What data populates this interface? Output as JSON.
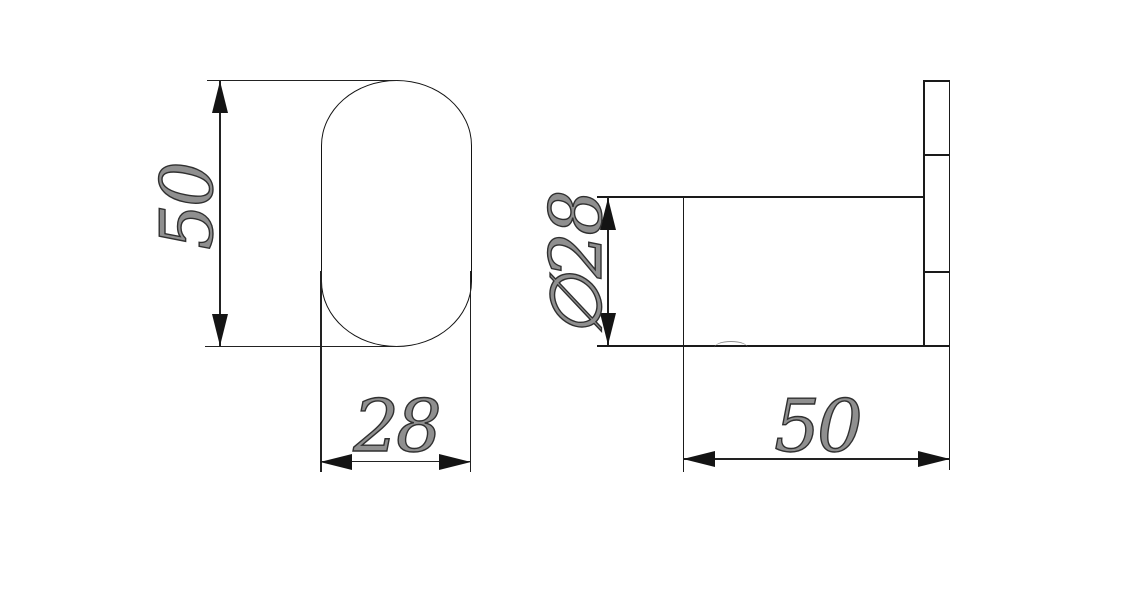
{
  "drawing": {
    "kind": "technical-dimension-drawing",
    "front_view": {
      "height_dim": "50",
      "width_dim": "28"
    },
    "side_view": {
      "diameter_dim": "∅28",
      "length_dim": "50"
    },
    "colors": {
      "background": "#ffffff",
      "line": "#1a1a1a",
      "dimension_text": "#303030"
    }
  }
}
